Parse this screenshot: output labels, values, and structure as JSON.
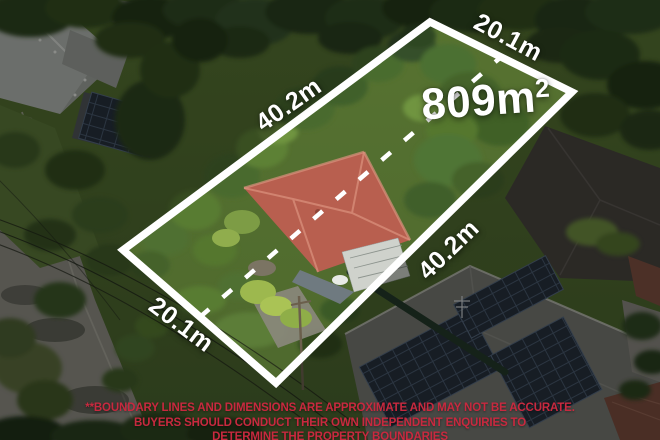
{
  "overlay": {
    "area_label": {
      "value": "809m",
      "sup": "2"
    },
    "dimensions": {
      "top_left": "40.2m",
      "top_right": "20.1m",
      "bottom_right": "40.2m",
      "bottom_left": "20.1m"
    },
    "boundary": {
      "color": "#ffffff",
      "corners": "123,250 430,22 572,92 276,383",
      "center_dash_points": "200,317 501,57"
    }
  },
  "disclaimer": {
    "color": "#c8293f",
    "line1": "**BOUNDARY LINES AND DIMENSIONS ARE APPROXIMATE AND MAY NOT BE ACCURATE.",
    "line2": "BUYERS SHOULD CONDUCT THEIR OWN INDEPENDENT ENQUIRIES TO",
    "line3": "DETERMINE THE PROPERTY BOUNDARIES"
  }
}
